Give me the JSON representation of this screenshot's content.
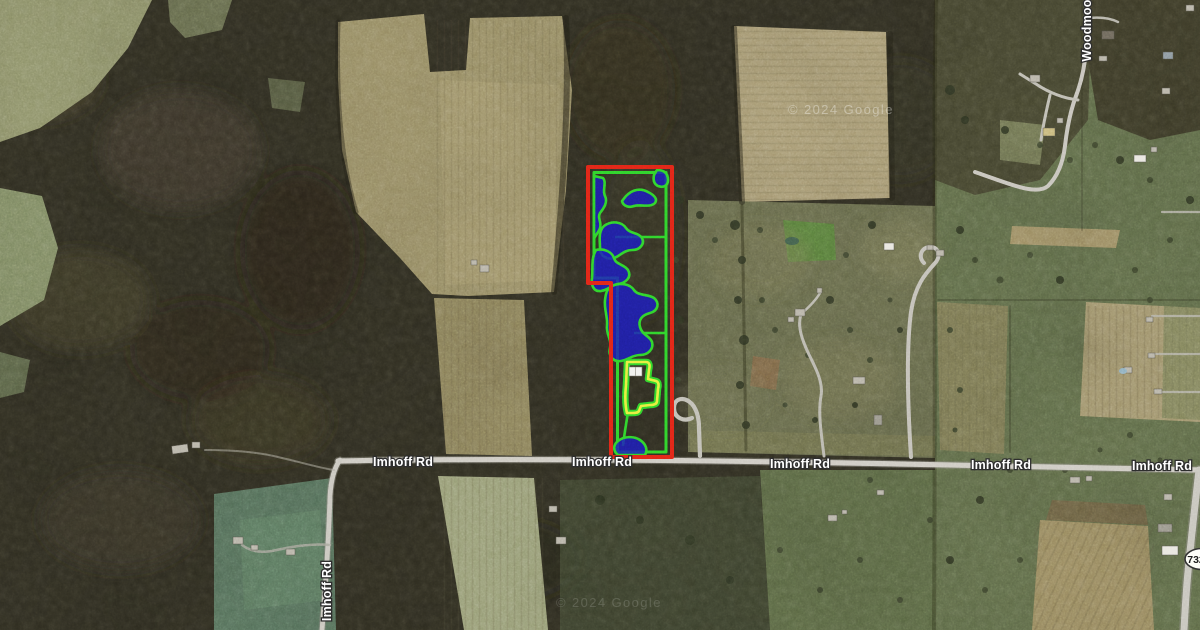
{
  "map": {
    "view_type": "satellite-aerial",
    "road_labels": [
      {
        "text": "Imhoff Rd",
        "orientation": "horizontal"
      },
      {
        "text": "Imhoff Rd",
        "orientation": "horizontal"
      },
      {
        "text": "Imhoff Rd",
        "orientation": "horizontal"
      },
      {
        "text": "Imhoff Rd",
        "orientation": "horizontal"
      },
      {
        "text": "Imhoff Rd",
        "orientation": "horizontal"
      },
      {
        "text": "Imhoff Rd",
        "orientation": "vertical"
      },
      {
        "text": "Woodmoor",
        "orientation": "vertical"
      }
    ],
    "route_shield": {
      "number": "732",
      "shape": "oval"
    },
    "watermarks": [
      {
        "text": "© 2024 Google"
      },
      {
        "text": "© 2024 Google"
      }
    ],
    "overlay_legend": {
      "parcel_boundary_color": "#e02517",
      "interior_subdivision_color": "#2fd32b",
      "wetland_fill_color": "#1c1cb5",
      "wetland_outline_color": "#2fd32b",
      "building_zone_color": "#e6ed3e",
      "building_roof_color": "#f2f2ee"
    }
  }
}
